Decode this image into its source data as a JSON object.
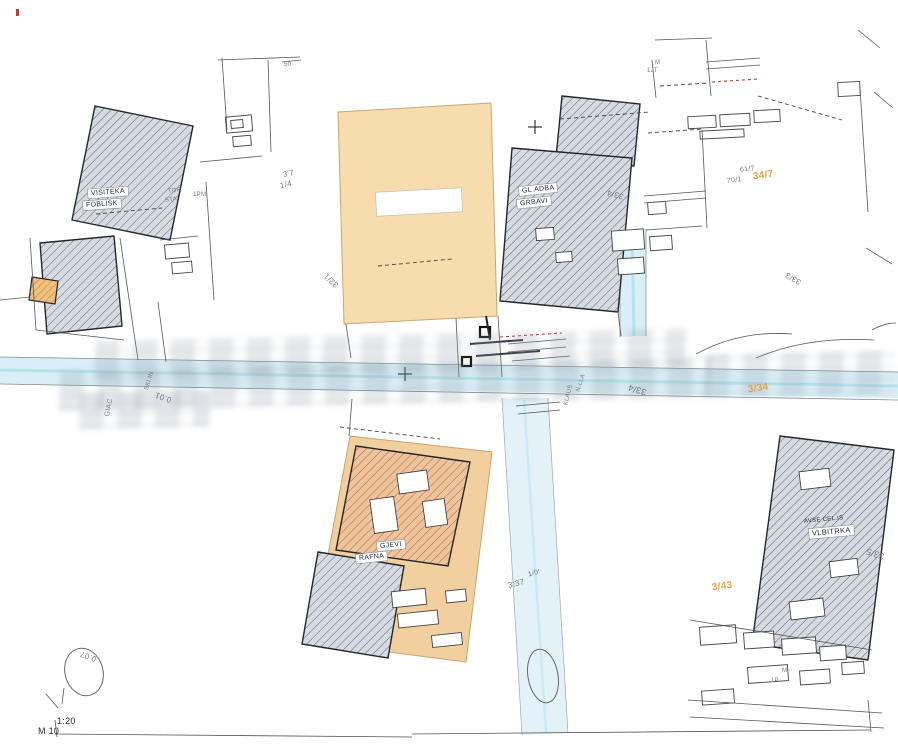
{
  "document": {
    "kind": "scanned cadastral / geodetic site plan",
    "scale_fragments": [
      "1:20",
      "M 10"
    ]
  },
  "watermark": {
    "present": true,
    "note": "faint illegible gray blocky watermark text across the centre of the plan"
  },
  "colors": {
    "ink": "#222733",
    "muted": "#73787f",
    "orange_text": "#e9a23b",
    "orange_fill": "#f7dcae",
    "orange_fill_deep": "#f2cf9f",
    "building_fill": "#d6dbe2",
    "hatch_line": "#59626e",
    "red_building_fill": "#edc49c",
    "red_hatch_line": "#b05f35",
    "orange_hatch_fill": "#eec17c",
    "orange_hatch_line": "#c07a35",
    "road_fill": "#daeef5",
    "road_center": "#b7e3ef",
    "line_dark": "#23272b",
    "line_mid": "#5b6066",
    "red_dash": "#c13a2c",
    "label_box": "#ffffff"
  },
  "parcels": {
    "highlighted": [
      {
        "name": "parcel-north-orange"
      },
      {
        "name": "parcel-south-orange"
      }
    ]
  },
  "labels": [
    {
      "name": "label-50",
      "text": "50",
      "x": 284,
      "y": 62,
      "rot": 0,
      "size": 6,
      "color": "muted"
    },
    {
      "name": "label-m-topright",
      "text": "M",
      "x": 655,
      "y": 60,
      "rot": 0,
      "size": 6,
      "color": "muted"
    },
    {
      "name": "label-1jt",
      "text": "1JT",
      "x": 647,
      "y": 68,
      "rot": 0,
      "size": 6,
      "color": "muted"
    },
    {
      "name": "building-label-nw-1",
      "text": "VISITEKA",
      "x": 88,
      "y": 188,
      "rot": -4,
      "size": 7,
      "color": "ink",
      "boxed": true
    },
    {
      "name": "building-label-nw-2",
      "text": "FOBLISK",
      "x": 83,
      "y": 200,
      "rot": -4,
      "size": 7,
      "color": "ink",
      "boxed": true
    },
    {
      "name": "label-top",
      "text": "TOP",
      "x": 168,
      "y": 188,
      "rot": -8,
      "size": 6,
      "color": "muted"
    },
    {
      "name": "label-sta",
      "text": "STA",
      "x": 165,
      "y": 197,
      "rot": -8,
      "size": 6,
      "color": "muted"
    },
    {
      "name": "label-1pm",
      "text": "1PM",
      "x": 193,
      "y": 192,
      "rot": 0,
      "size": 6,
      "color": "muted"
    },
    {
      "name": "parcel-label-337",
      "text": "3'7",
      "x": 283,
      "y": 170,
      "rot": -12,
      "size": 8,
      "color": "muted"
    },
    {
      "name": "parcel-label-114",
      "text": "1/4",
      "x": 280,
      "y": 181,
      "rot": -12,
      "size": 8,
      "color": "muted"
    },
    {
      "name": "parcel-label-321",
      "text": "32/1",
      "x": 323,
      "y": 276,
      "rot": -137,
      "size": 8,
      "color": "muted"
    },
    {
      "name": "building-label-n-1",
      "text": "GL.ADBA",
      "x": 519,
      "y": 185,
      "rot": -6,
      "size": 7,
      "color": "ink",
      "boxed": true
    },
    {
      "name": "building-label-n-2",
      "text": "GRBAVI",
      "x": 517,
      "y": 198,
      "rot": -6,
      "size": 7,
      "color": "ink",
      "boxed": true
    },
    {
      "name": "parcel-label-334-n",
      "text": "33/4",
      "x": 607,
      "y": 190,
      "rot": -163,
      "size": 8,
      "color": "muted"
    },
    {
      "name": "parcel-label-617",
      "text": "61/7",
      "x": 740,
      "y": 166,
      "rot": -7,
      "size": 7,
      "color": "muted"
    },
    {
      "name": "parcel-label-701",
      "text": "70/1",
      "x": 727,
      "y": 177,
      "rot": -7,
      "size": 7,
      "color": "muted"
    },
    {
      "name": "parcel-label-347-orange",
      "text": "34/7",
      "x": 753,
      "y": 171,
      "rot": -8,
      "size": 10,
      "color": "orange_text",
      "bold": true
    },
    {
      "name": "parcel-label-333",
      "text": "33/3",
      "x": 785,
      "y": 274,
      "rot": -150,
      "size": 8,
      "color": "muted"
    },
    {
      "name": "parcel-label-334-mid",
      "text": "33/4",
      "x": 628,
      "y": 385,
      "rot": -163,
      "size": 9,
      "color": "muted"
    },
    {
      "name": "parcel-label-334-orange",
      "text": "3/34",
      "x": 748,
      "y": 384,
      "rot": -8,
      "size": 10,
      "color": "orange_text",
      "bold": true
    },
    {
      "name": "label-001",
      "text": "0.01",
      "x": 155,
      "y": 393,
      "rot": -160,
      "size": 8,
      "color": "muted"
    },
    {
      "name": "street-label-giac",
      "text": "GIAC",
      "x": 100,
      "y": 404,
      "rot": -78,
      "size": 7,
      "color": "muted"
    },
    {
      "name": "street-label-skiin",
      "text": "SKI.IN",
      "x": 140,
      "y": 378,
      "rot": -72,
      "size": 6,
      "color": "muted"
    },
    {
      "name": "street-label-klaus",
      "text": "KLAUS",
      "x": 558,
      "y": 392,
      "rot": -76,
      "size": 6,
      "color": "muted"
    },
    {
      "name": "street-label-nlla",
      "text": "N.LLA",
      "x": 572,
      "y": 380,
      "rot": -72,
      "size": 6,
      "color": "muted"
    },
    {
      "name": "building-label-s-1",
      "text": "GJEVI",
      "x": 377,
      "y": 541,
      "rot": -6,
      "size": 7,
      "color": "ink",
      "boxed": true
    },
    {
      "name": "building-label-s-2",
      "text": "RAFNA",
      "x": 356,
      "y": 553,
      "rot": -6,
      "size": 7,
      "color": "ink",
      "boxed": true
    },
    {
      "name": "building-label-e-0",
      "text": "AVSE CEL.IS",
      "x": 804,
      "y": 517,
      "rot": -5,
      "size": 6,
      "color": "ink"
    },
    {
      "name": "building-label-e-1",
      "text": "VLBITRKA",
      "x": 809,
      "y": 527,
      "rot": -5,
      "size": 7.5,
      "color": "ink",
      "boxed": true
    },
    {
      "name": "parcel-label-335",
      "text": "33/5",
      "x": 866,
      "y": 549,
      "rot": -160,
      "size": 9,
      "color": "muted"
    },
    {
      "name": "parcel-label-343-orange",
      "text": "3/43",
      "x": 712,
      "y": 582,
      "rot": -8,
      "size": 10,
      "color": "orange_text",
      "bold": true
    },
    {
      "name": "label-10",
      "text": "1/0'",
      "x": 528,
      "y": 570,
      "rot": -14,
      "size": 7,
      "color": "muted"
    },
    {
      "name": "label-337-s",
      "text": "3:37",
      "x": 508,
      "y": 580,
      "rot": -14,
      "size": 8,
      "color": "muted"
    },
    {
      "name": "label-007-sw",
      "text": "0.07",
      "x": 80,
      "y": 652,
      "rot": -160,
      "size": 8,
      "color": "muted"
    },
    {
      "name": "label-m-se",
      "text": "M",
      "x": 782,
      "y": 668,
      "rot": 0,
      "size": 6,
      "color": "muted"
    },
    {
      "name": "label-1p",
      "text": "1P",
      "x": 771,
      "y": 678,
      "rot": 0,
      "size": 6,
      "color": "muted"
    },
    {
      "name": "scale-label-line1",
      "text": "1:20",
      "x": 57,
      "y": 717,
      "rot": 0,
      "size": 9,
      "color": "ink"
    },
    {
      "name": "scale-label-line2",
      "text": "M 10",
      "x": 38,
      "y": 727,
      "rot": 0,
      "size": 9,
      "color": "ink"
    }
  ]
}
